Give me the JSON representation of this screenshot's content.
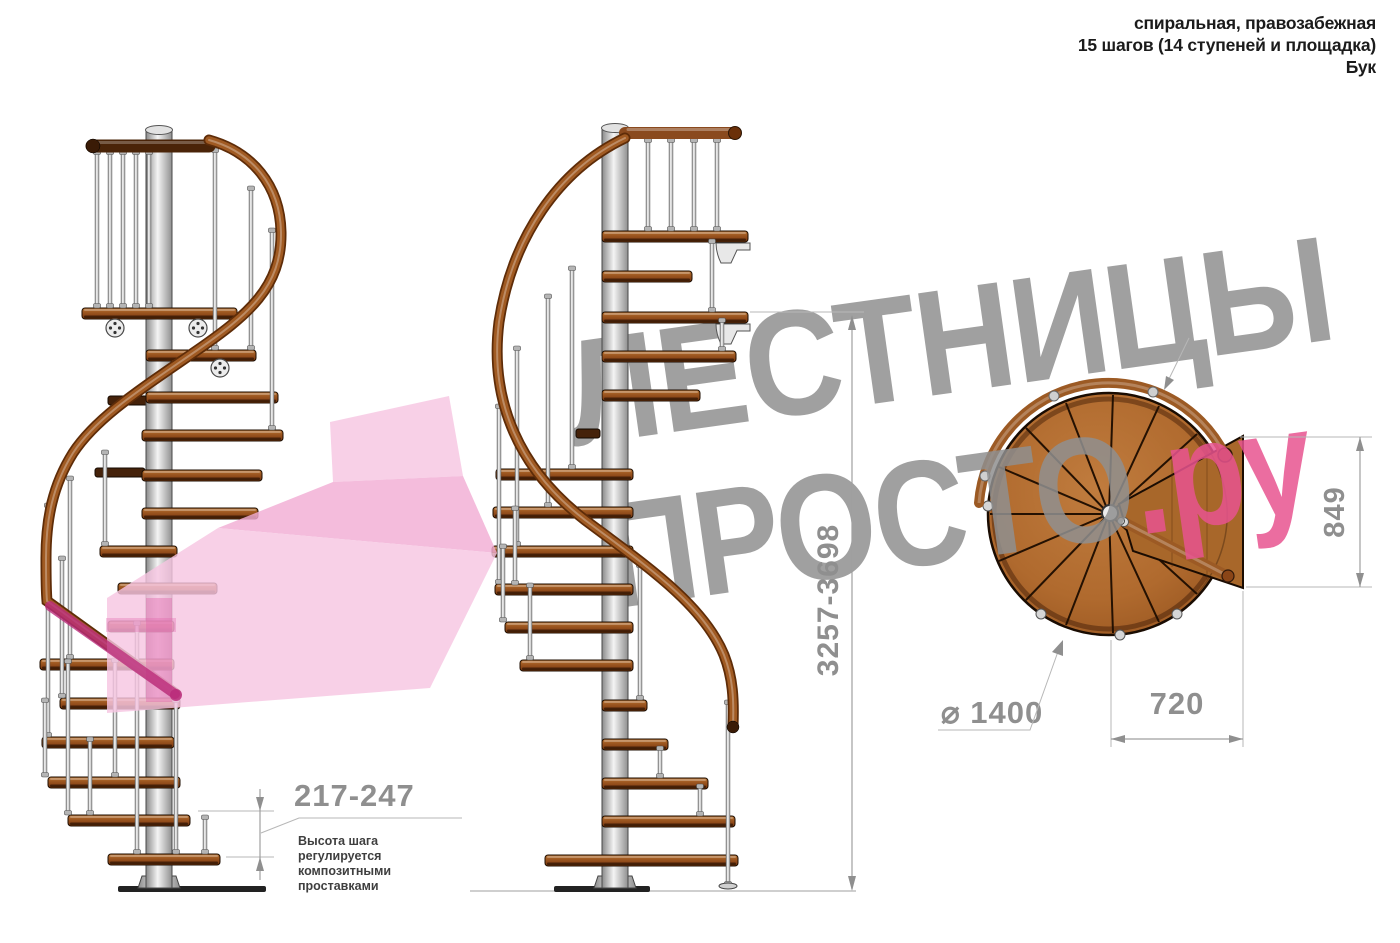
{
  "header": {
    "line1": "спиральная, правозабежная",
    "line2": "15 шагов (14 ступеней и площадка)",
    "line3": "Бук"
  },
  "watermark": {
    "line1": "ЛЕСТНИЦЫ",
    "line2_main": "ПРОСТО",
    "line2_suffix": ".ру"
  },
  "dimensions": {
    "step_height": "217-247",
    "total_height": "3257-3698",
    "platform_height": "849",
    "platform_width": "720",
    "diameter": "⌀ 1400"
  },
  "note": {
    "line1": "Высота шага",
    "line2": "регулируется",
    "line3": "композитными",
    "line4": "проставками"
  },
  "colors": {
    "watermark_gray": "#8f8f8f",
    "brand_pink": "#e8538f",
    "arrow_pink_light": "#f7c6e2",
    "arrow_pink_mid": "#f2add4",
    "wood": "#a05a22",
    "wood_dark": "#5e2c08",
    "metal_light": "#f2f2f2",
    "dimension_gray": "#8f8f8f"
  }
}
